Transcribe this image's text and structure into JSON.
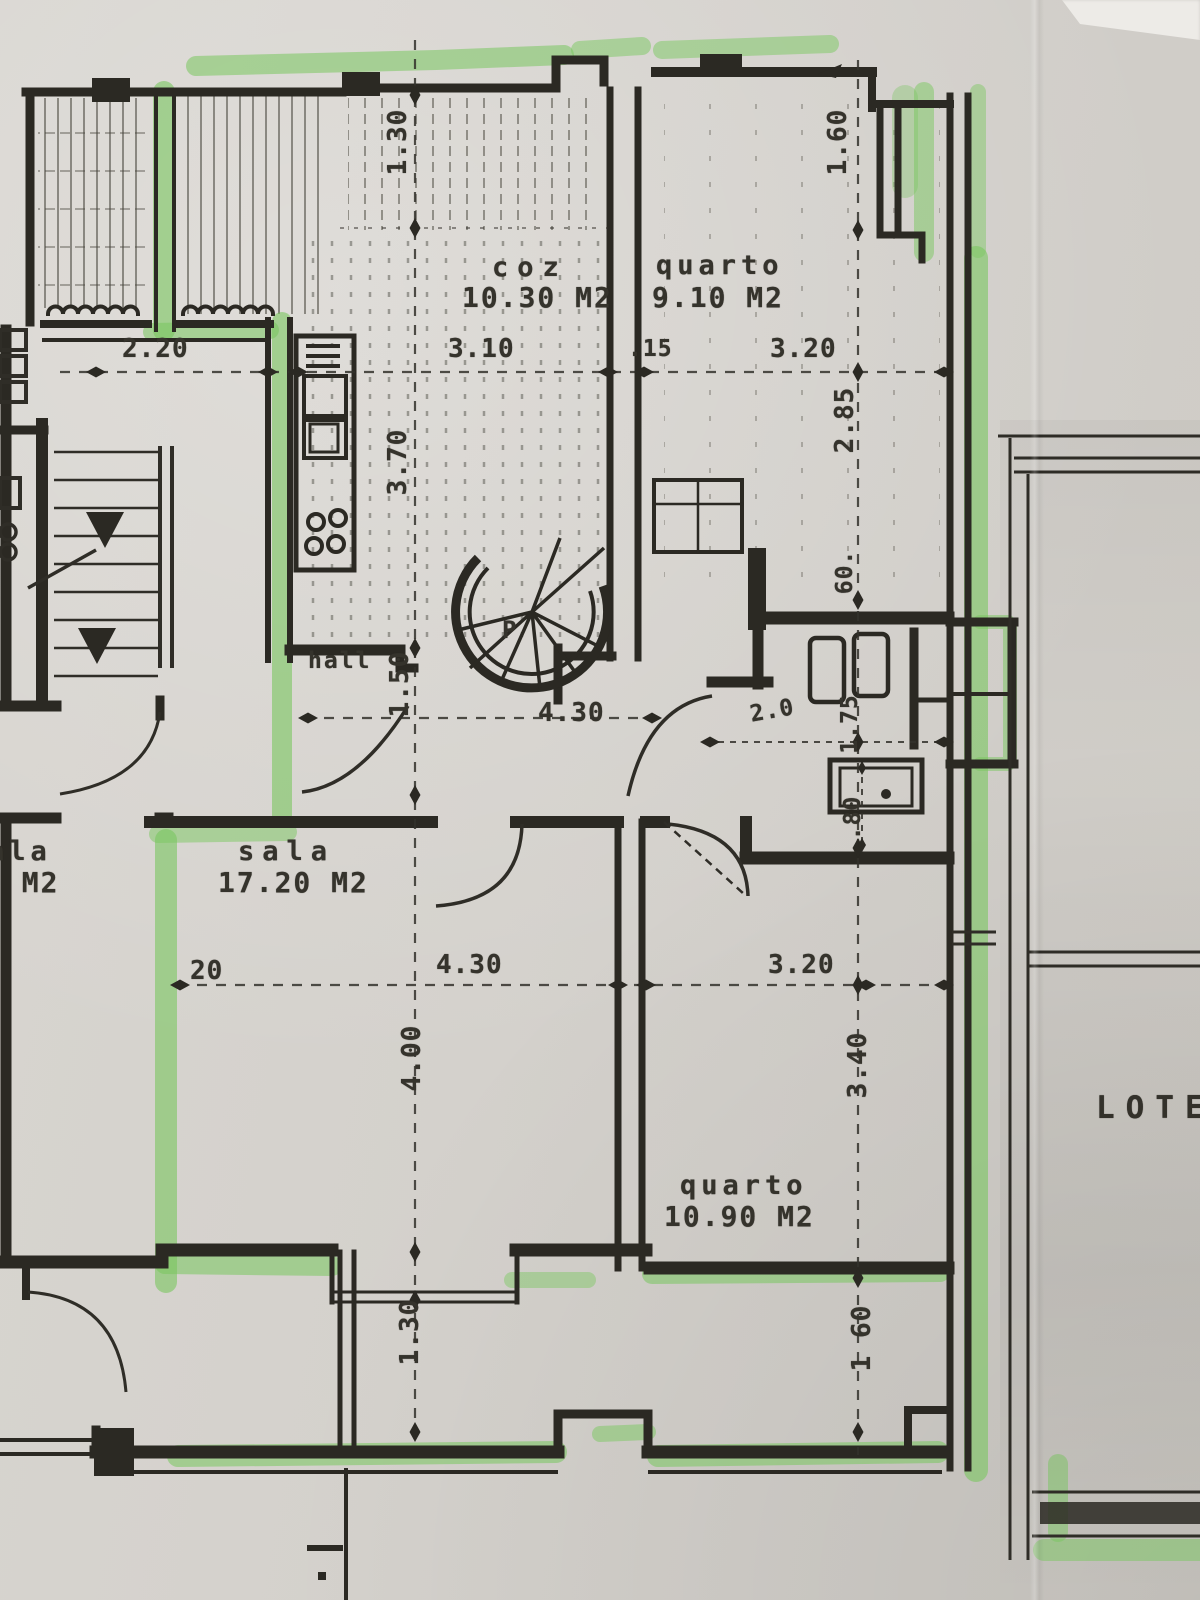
{
  "palette": {
    "paper": "#d4d1cc",
    "ink": "#2b2923",
    "marker_green": "#79c75f",
    "label_text": "#35332c"
  },
  "plan": {
    "rooms": {
      "kitchen": {
        "label": "coz",
        "area": "10.30 M2"
      },
      "bedroom_top": {
        "label": "quarto",
        "area": "9.10 M2"
      },
      "living": {
        "label": "sala",
        "area": "17.20 M2"
      },
      "bedroom_bottom": {
        "label": "quarto",
        "area": "10.90 M2"
      },
      "hall": {
        "label": "hall"
      },
      "neighbor_living": {
        "label_fragment": "ala",
        "area_fragment": "0 M2"
      },
      "stair_letter": "P",
      "lot_label": "LOTE"
    },
    "dims": {
      "top_depth": "1.30",
      "top_right_depth": "1.60",
      "neighbor_width": "2.20",
      "kitchen_width": "3.10",
      "wall_thickness": ".15",
      "bedroom_top_width": "3.20",
      "kitchen_depth": "3.70",
      "bedroom_top_depth": "2.85",
      "shaft_width": "60.",
      "hall_depth": "1.50",
      "hall_width": "4.30",
      "bath_width": "2.0",
      "bath_depth": "1.75",
      "door_width": ".80",
      "wall_20": "20",
      "living_width": "4.30",
      "living_depth": "4.00",
      "bedroom_bottom_width": "3.20",
      "bedroom_bottom_depth": "3.40",
      "bottom_depth": "1.30",
      "bottom_right_depth": "1 60"
    }
  }
}
